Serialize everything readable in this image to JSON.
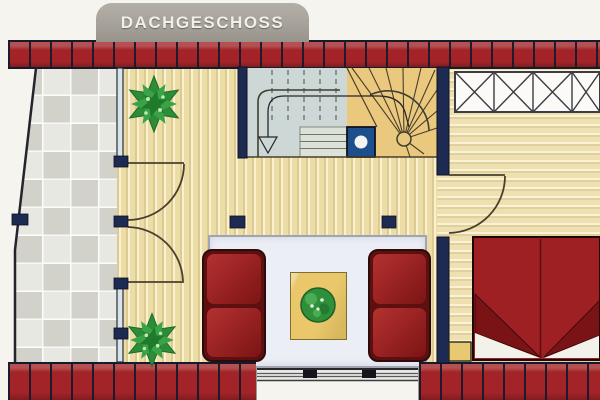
{
  "banner": {
    "label": "DACHGESCHOSS"
  },
  "palette": {
    "page_bg": "#f6f4ee",
    "banner_gray": "#a7a299",
    "banner_text": "#f1efe9",
    "brick_red": "#a32428",
    "brick_joint": "#171a2b",
    "wall_navy": "#1d2b52",
    "plan_line": "#4a3f2c",
    "wood_floor_light": "#f2e3ad",
    "wood_floor_right": "#f4e7b8",
    "terrace_tile_light": "#e8e8e3",
    "terrace_tile_dark": "#d2d2cb",
    "stair_blue_gray": "#cdd7d5",
    "stair_tan": "#eac87e",
    "landing_gray": "#dde2d8",
    "chimney_blue": "#1c4f8c",
    "glazing_blue": "#d7e4ea",
    "sofa_red": "#9b2222",
    "bed_red": "#9e2023",
    "bed_fold_dark": "#7a1316",
    "bed_linen_white": "#f2f1ea",
    "rug_white": "#eceef6",
    "mat_yellow": "#e9c76a",
    "plant_green": "#2f8f3a",
    "tree_green": "#2c8c38",
    "railing_line": "#3c3c44"
  },
  "elements": [
    "title-banner",
    "top-brick-wall",
    "bottom-brick-wall",
    "sloped-attic-wall",
    "stone-terrace",
    "terrace-glazed-wall",
    "terrace-french-doors",
    "wall-posts",
    "living-room-wood-floor",
    "gallery-wood-floor",
    "support-columns",
    "winder-staircase",
    "stair-headroom-dashes",
    "stair-walk-line",
    "down-arrow",
    "chimney-block",
    "newel-post",
    "gallery-x-railing",
    "bedroom-door",
    "bedroom-wall",
    "double-bed",
    "blanket-folds",
    "bedside-table",
    "area-rug",
    "coffee-mat",
    "potted-plant",
    "sofa-left",
    "sofa-right",
    "tree-top",
    "tree-bottom",
    "sliding-window",
    "window-handles"
  ]
}
